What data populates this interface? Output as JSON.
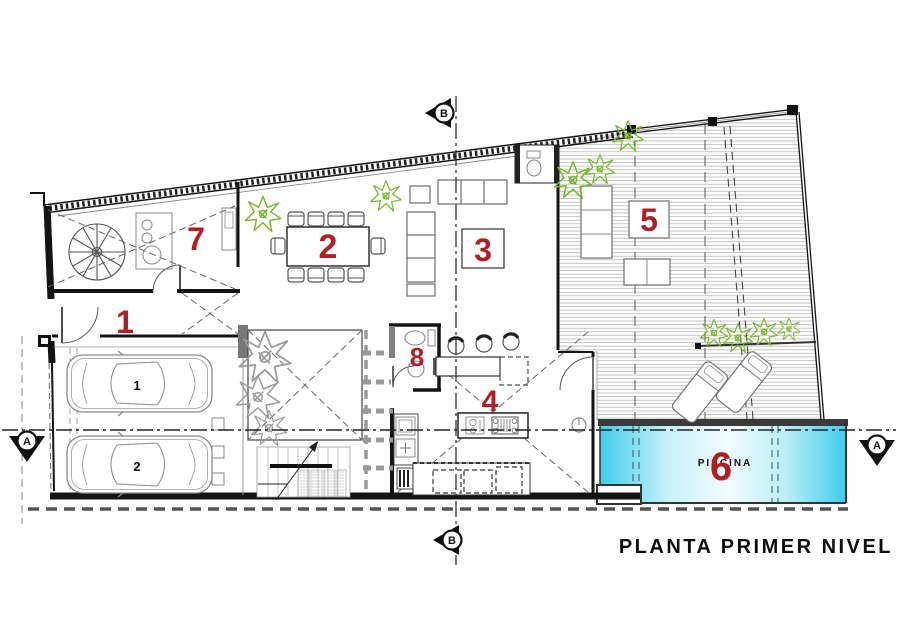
{
  "title": "PLANTA PRIMER NIVEL",
  "rooms": {
    "r1": "1",
    "r2": "2",
    "r3": "3",
    "r4": "4",
    "r5": "5",
    "r6": "6",
    "r7": "7",
    "r8": "8"
  },
  "pool": {
    "label": "PISCINA"
  },
  "cars": {
    "car1": "1",
    "car2": "2"
  },
  "section_markers": {
    "a": "A",
    "b": "B"
  },
  "colors": {
    "room_number_red": "#b01f24",
    "pool_cyan": "#4fd3ef",
    "plant_green": "#76b82a",
    "tree_gray": "#9b9b9b",
    "wall_black": "#141414",
    "furniture_gray": "#6f6f6f",
    "deck_line_gray": "#b5b5b5"
  }
}
